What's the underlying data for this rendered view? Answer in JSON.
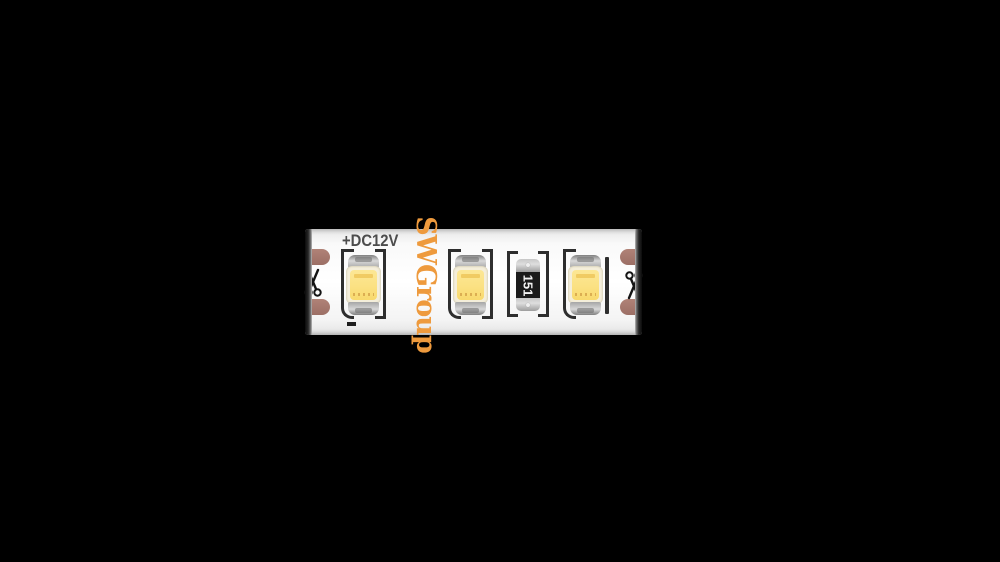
{
  "scene": {
    "description": "product photo of LED strip segment on black background",
    "background_color": "#000000"
  },
  "strip": {
    "voltage_label": "+DC12V",
    "brand": "SWGroup",
    "brand_color": "#ee9a3d",
    "polarity_minus_label": "-",
    "resistor_value": "151",
    "led_count": 3,
    "colors": {
      "strip_body": "#f8f8f8",
      "copper_pad": "#a5766c",
      "silkscreen_outline": "#2e2e2e",
      "led_phosphor": "#fbe183",
      "voltage_text": "#4c4c4c",
      "resistor_body": "#1b1b1b"
    },
    "icons": {
      "cut_mark_left": "scissors-icon",
      "cut_mark_right": "scissors-icon"
    }
  }
}
